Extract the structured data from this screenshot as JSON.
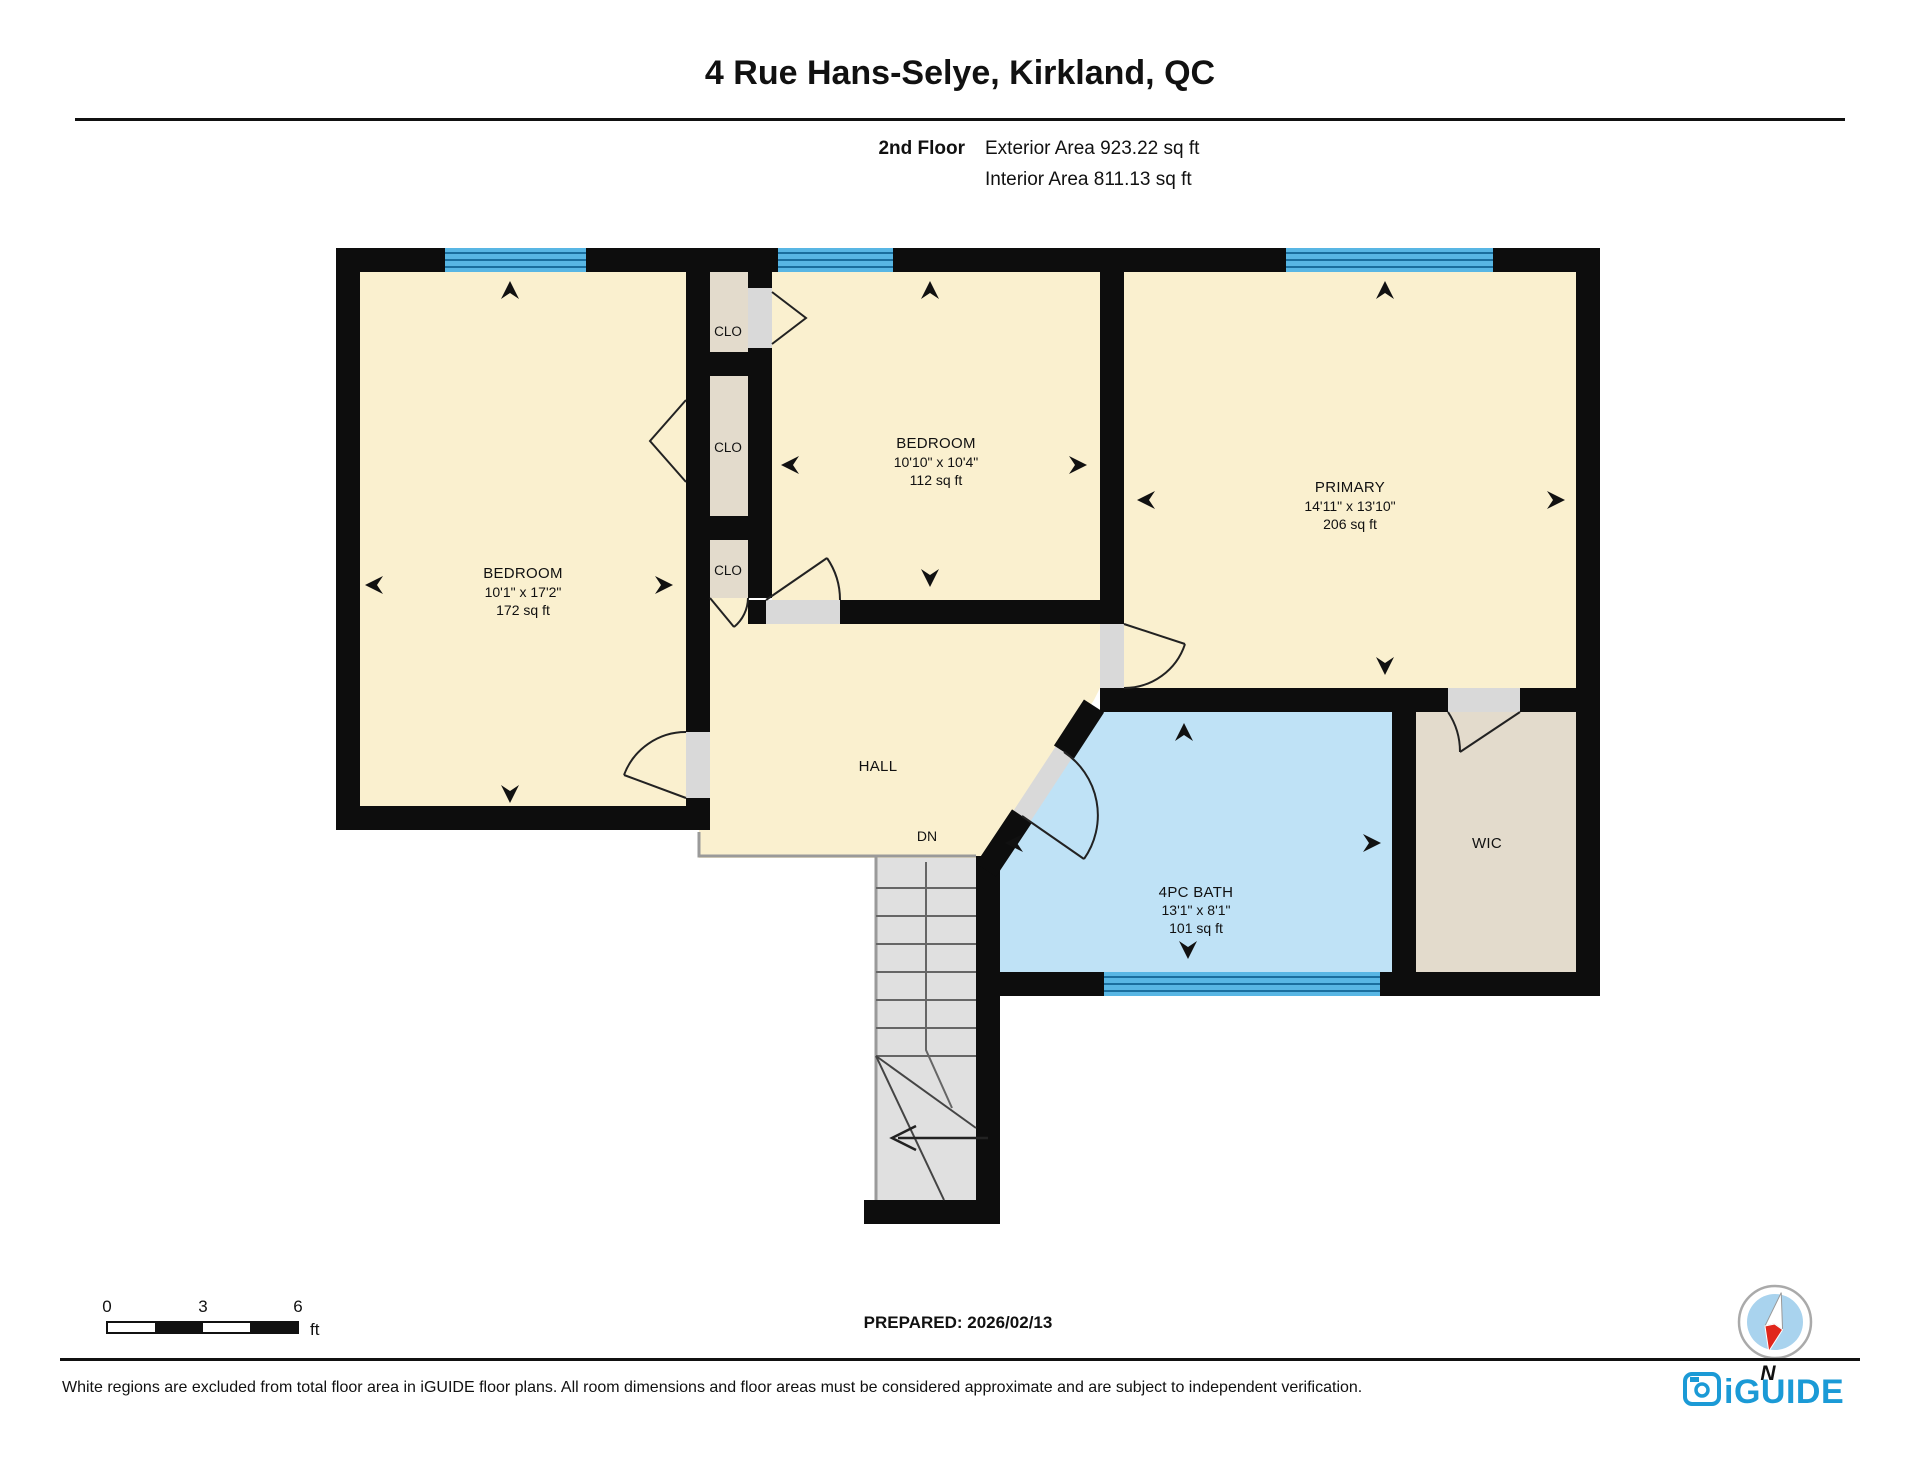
{
  "header": {
    "title": "4 Rue Hans-Selye, Kirkland, QC",
    "floor_label": "2nd Floor",
    "exterior_area": "Exterior Area 923.22 sq ft",
    "interior_area": "Interior Area 811.13 sq ft"
  },
  "rooms": {
    "bedroom_left": {
      "name": "BEDROOM",
      "dims": "10'1\" x 17'2\"",
      "area": "172 sq ft"
    },
    "bedroom_middle": {
      "name": "BEDROOM",
      "dims": "10'10\" x 10'4\"",
      "area": "112 sq ft"
    },
    "primary": {
      "name": "PRIMARY",
      "dims": "14'11\" x 13'10\"",
      "area": "206 sq ft"
    },
    "bath": {
      "name": "4PC BATH",
      "dims": "13'1\" x 8'1\"",
      "area": "101 sq ft"
    },
    "hall": {
      "name": "HALL"
    },
    "wic": {
      "name": "WIC"
    },
    "closet_top": {
      "name": "CLO"
    },
    "closet_middle": {
      "name": "CLO"
    },
    "closet_bottom": {
      "name": "CLO"
    },
    "stairs": {
      "label": "DN"
    }
  },
  "scale_bar": {
    "tick_0": "0",
    "tick_3": "3",
    "tick_6": "6",
    "unit": "ft"
  },
  "compass": {
    "label": "N"
  },
  "prepared": "PREPARED: 2026/02/13",
  "footer": {
    "disclaimer": "White regions are excluded from total floor area in iGUIDE floor plans. All room dimensions and floor areas must be considered approximate and are subject to independent verification.",
    "brand": "iGUIDE"
  },
  "colors": {
    "room_fill": "#FAF0CF",
    "closet_fill": "#E3DBCC",
    "bath_fill": "#BFE2F6",
    "window_blue": "#58B6E4",
    "wall": "#0D0D0D",
    "stairs_fill": "#E0E0E0",
    "brand_blue": "#1B9AD6"
  }
}
